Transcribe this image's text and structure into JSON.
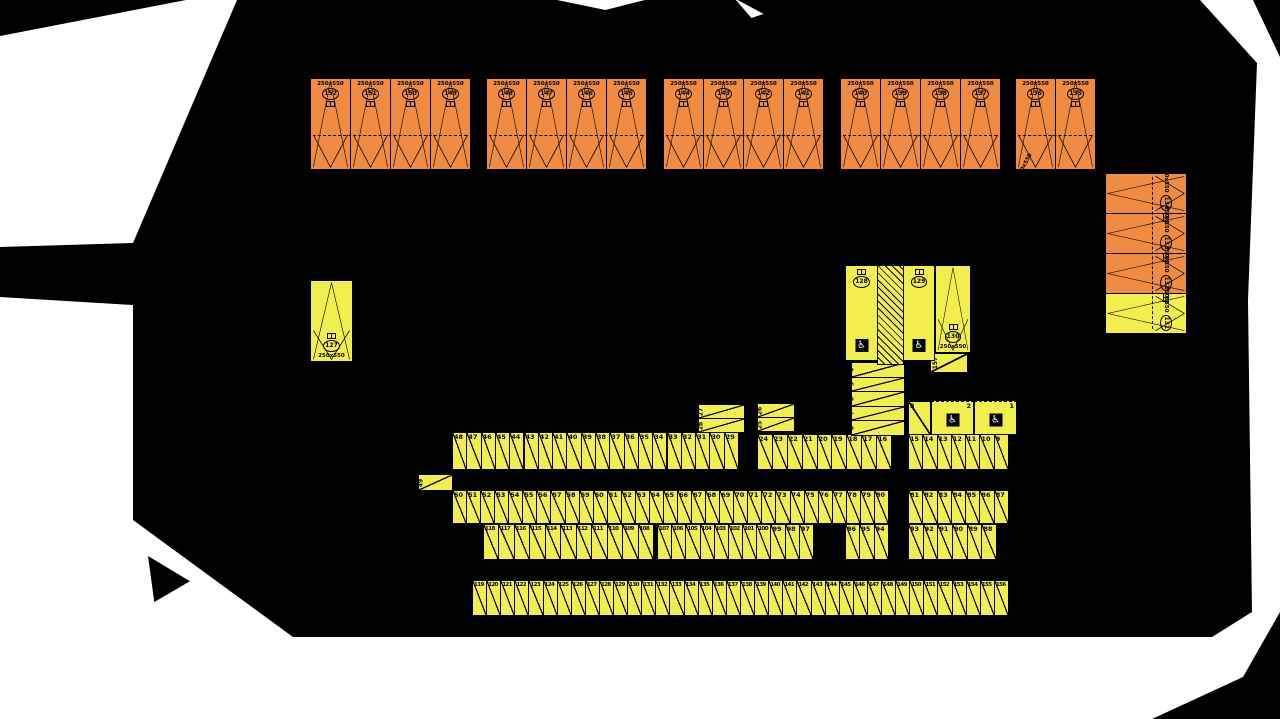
{
  "colors": {
    "orange": "#F08B42",
    "yellow": "#F2EE4D",
    "sheet": "#FFFFFF",
    "background": "#000000",
    "line": "#000000"
  },
  "size_label": "250x550",
  "rotated_size_note": "250x550",
  "wheelchair_symbol": "♿",
  "boundary_marks": "✕ ✕ ✕",
  "top_row_groups": [
    {
      "stalls": [
        "152",
        "151",
        "150",
        "149"
      ]
    },
    {
      "stalls": [
        "148",
        "147",
        "146",
        "145"
      ]
    },
    {
      "stalls": [
        "144",
        "143",
        "142",
        "141"
      ]
    },
    {
      "stalls": [
        "140",
        "139",
        "138",
        "137"
      ]
    },
    {
      "stalls": [
        "136",
        "135"
      ]
    }
  ],
  "right_column_stalls": [
    {
      "num": "134",
      "color": "orange"
    },
    {
      "num": "133",
      "color": "orange"
    },
    {
      "num": "132",
      "color": "orange"
    },
    {
      "num": "131",
      "color": "yellow"
    }
  ],
  "left_stall": {
    "num": "127",
    "size": "250x550"
  },
  "accessible_stalls": [
    {
      "num": "128"
    },
    {
      "num": "129"
    }
  ],
  "stall_130": {
    "num": "130",
    "size": "250x550"
  },
  "rows": {
    "a1": [
      "48",
      "47",
      "46",
      "45",
      "44",
      "43",
      "42",
      "41",
      "40",
      "39",
      "38",
      "37",
      "36",
      "35",
      "34",
      "33",
      "32",
      "31",
      "30",
      "29"
    ],
    "a2": [
      "24",
      "23",
      "22",
      "21",
      "20",
      "19",
      "18",
      "17",
      "16"
    ],
    "a3": [
      "15",
      "14",
      "13",
      "12",
      "11",
      "10",
      "9"
    ],
    "b1": [
      "50",
      "51",
      "52",
      "53",
      "54",
      "55",
      "56",
      "57",
      "58",
      "59",
      "60",
      "61",
      "62",
      "63",
      "64",
      "65",
      "66",
      "67",
      "68",
      "69",
      "70",
      "71",
      "72",
      "73",
      "74",
      "75",
      "76",
      "77",
      "78",
      "79",
      "80"
    ],
    "b2": [
      "81",
      "82",
      "83",
      "84",
      "85",
      "86",
      "87"
    ],
    "c1": [
      "118",
      "117",
      "116",
      "115",
      "114",
      "113",
      "112",
      "111",
      "110",
      "109",
      "108"
    ],
    "c2": [
      "107",
      "106",
      "105",
      "104",
      "103",
      "102",
      "101",
      "100",
      "99",
      "98",
      "97"
    ],
    "c3": [
      "96",
      "95",
      "94"
    ],
    "c4": [
      "93",
      "92",
      "91",
      "90",
      "89",
      "88"
    ],
    "d": [
      "119",
      "120",
      "121",
      "122",
      "123",
      "124",
      "125",
      "126",
      "127",
      "128",
      "129",
      "130",
      "131",
      "132",
      "133",
      "134",
      "135",
      "136",
      "137",
      "138",
      "139",
      "140",
      "141",
      "142",
      "143",
      "144",
      "145",
      "146",
      "147",
      "148",
      "149",
      "150",
      "151",
      "152",
      "153",
      "154",
      "155",
      "156"
    ]
  },
  "horizontal_stalls": {
    "s49": "49",
    "s27": "27",
    "s28": "28",
    "s26": "26",
    "s25": "25",
    "s157": "157"
  },
  "stall_3": "3",
  "ramp_stack": [
    "4",
    "5",
    "6",
    "7",
    "8"
  ],
  "wheelchair_wide_stalls": [
    {
      "num": "2"
    },
    {
      "num": "1"
    }
  ]
}
